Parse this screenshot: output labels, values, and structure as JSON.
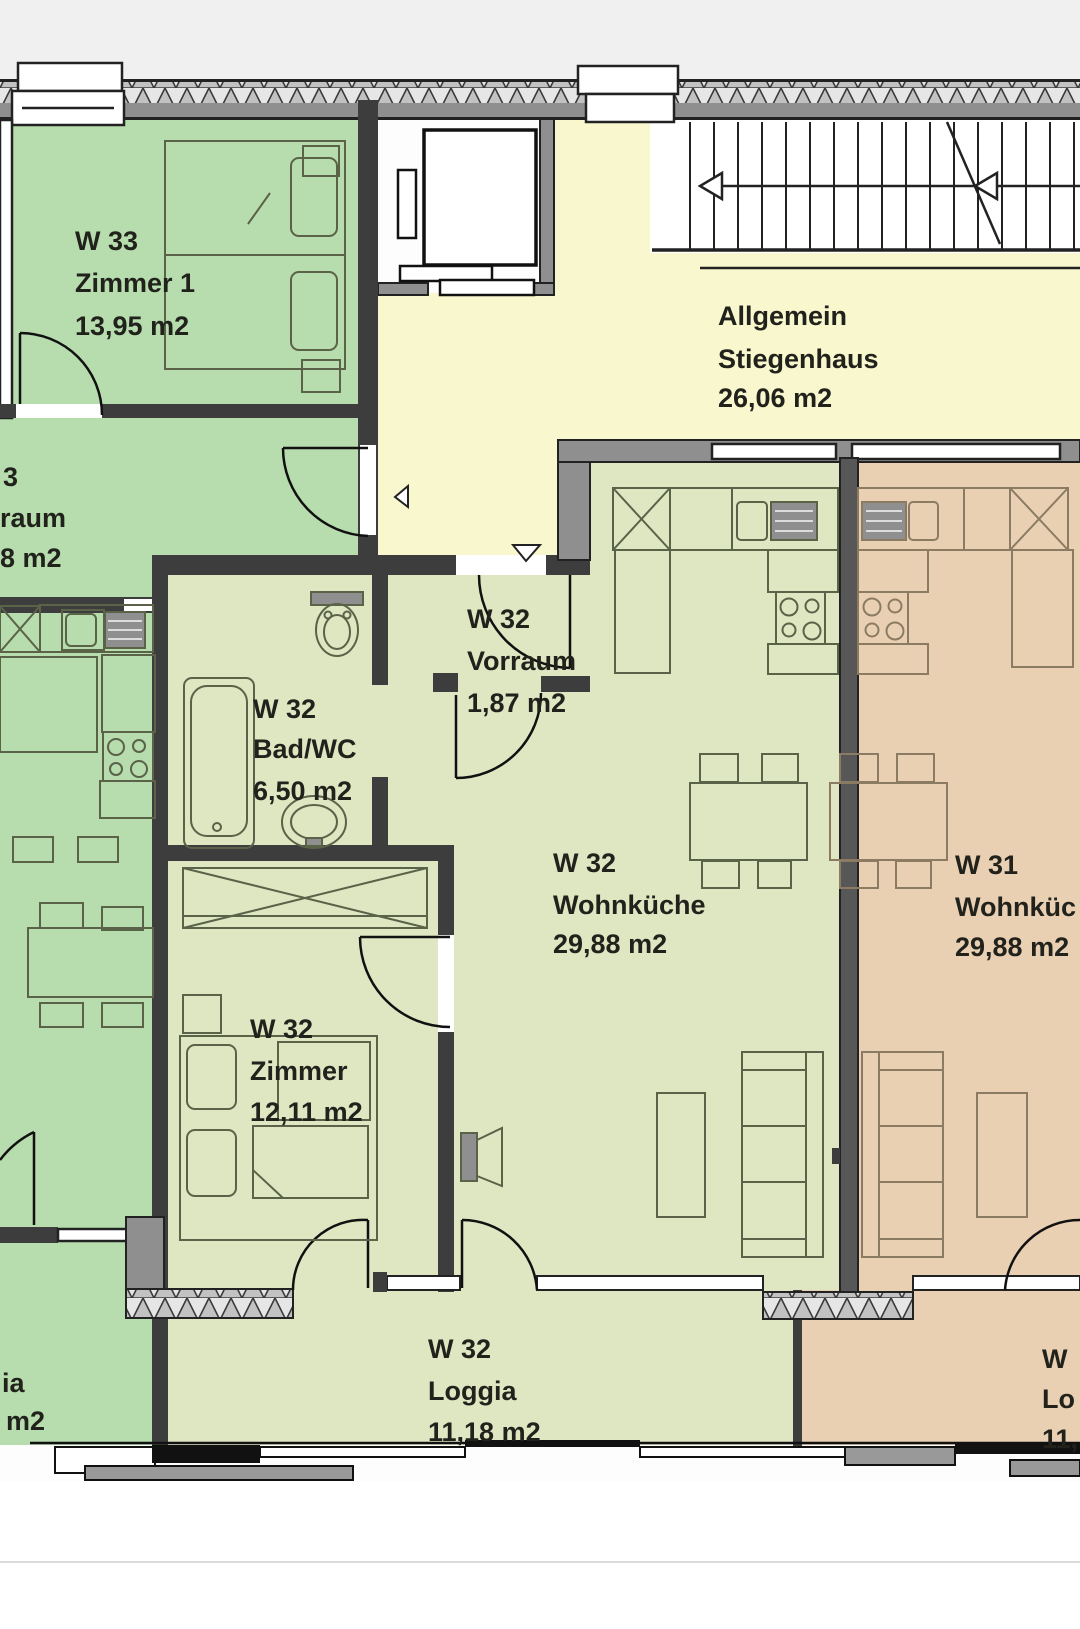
{
  "labels": {
    "w33_zimmer1": [
      "W 33",
      "Zimmer 1",
      "13,95 m2"
    ],
    "stiegenhaus": [
      "Allgemein",
      "Stiegenhaus",
      "26,06 m2"
    ],
    "w33_vorraum_cut": [
      "3",
      "raum",
      "8 m2"
    ],
    "w32_vorraum": [
      "W 32",
      "Vorraum",
      "1,87 m2"
    ],
    "w32_bad": [
      "W 32",
      "Bad/WC",
      "6,50 m2"
    ],
    "w32_wohnkueche": [
      "W 32",
      "Wohnküche",
      "29,88 m2"
    ],
    "w31_wohnkueche": [
      "W 31",
      "Wohnküc",
      "29,88 m2"
    ],
    "w32_zimmer": [
      "W 32",
      "Zimmer",
      "12,11 m2"
    ],
    "w32_loggia": [
      "W 32",
      "Loggia",
      "11,18 m2"
    ],
    "w33_loggia_cut": [
      "ia",
      "m2"
    ],
    "w31_loggia_cut": [
      "W",
      "Lo",
      "11,"
    ]
  },
  "colors": {
    "w33_green": "#b7dcae",
    "stiegenhaus_yellow": "#f9f7cd",
    "w32_pale_green": "#dfe6c2",
    "w31_tan": "#e9d0b3",
    "wall_dark": "#3d3d3d",
    "wall_gray": "#8f8f8f",
    "page_top": "#f0f0f0"
  }
}
